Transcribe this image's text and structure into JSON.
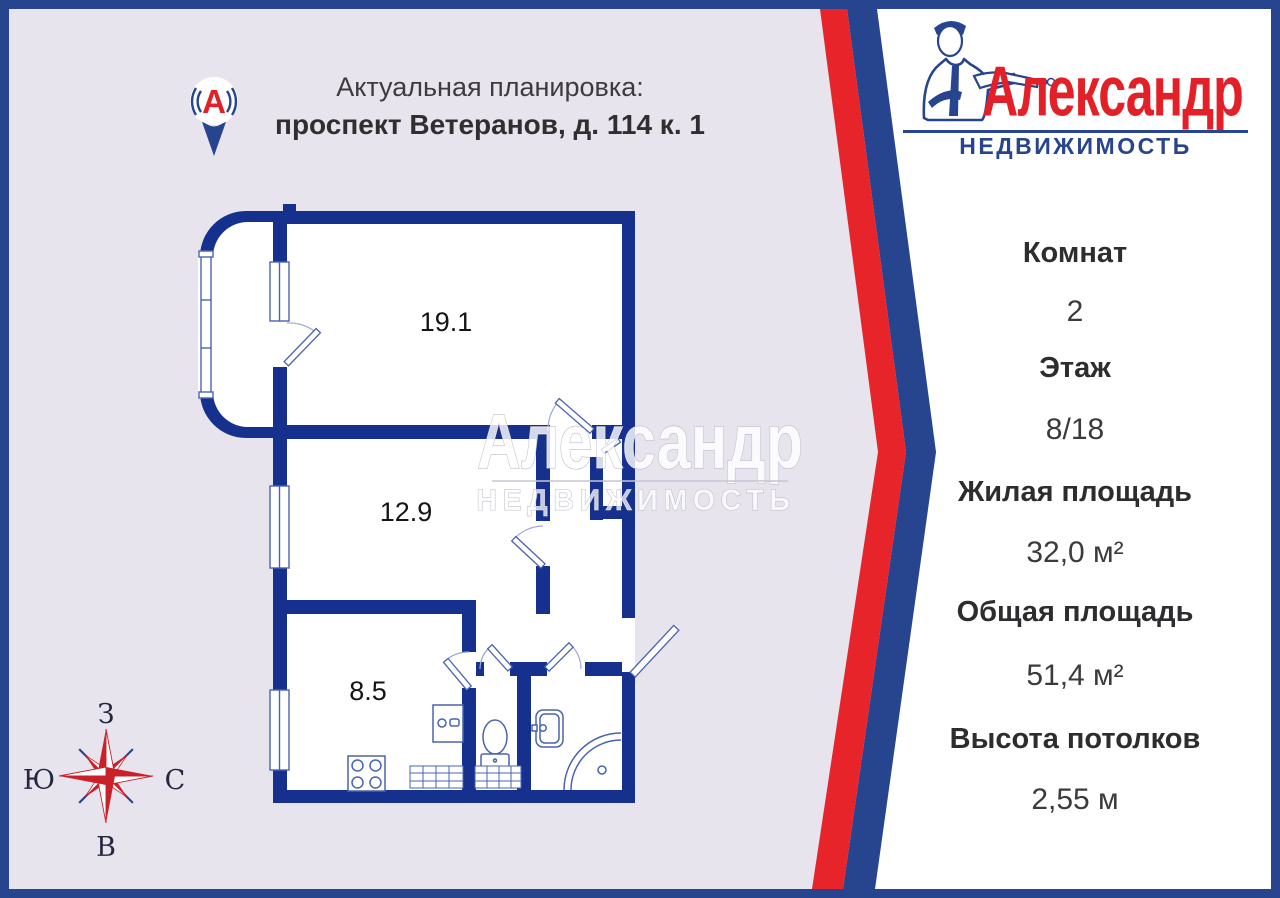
{
  "page": {
    "background": "#e8e4ee",
    "border_color": "#27458e",
    "accent_red": "#e8242b",
    "accent_navy": "#27458e",
    "wall_color": "#15318d"
  },
  "header": {
    "pin_letter": "А",
    "title": "Актуальная планировка:",
    "address": "проспект Ветеранов, д. 114 к. 1"
  },
  "logo": {
    "name": "Александр",
    "subtitle": "НЕДВИЖИМОСТЬ",
    "name_color": "#e32027",
    "subtitle_color": "#27458e"
  },
  "watermark": {
    "line1": "Александр",
    "line2": "НЕДВИЖИМОСТЬ"
  },
  "details": {
    "rows": [
      {
        "label": "Комнат",
        "value": "2"
      },
      {
        "label": "Этаж",
        "value": "8/18"
      },
      {
        "label": "Жилая площадь",
        "value": "32,0 м²"
      },
      {
        "label": "Общая площадь",
        "value": "51,4 м²"
      },
      {
        "label": "Высота потолков",
        "value": "2,55 м"
      }
    ]
  },
  "floor_plan": {
    "rooms": [
      {
        "name": "living-room",
        "area": "19.1"
      },
      {
        "name": "bedroom",
        "area": "12.9"
      },
      {
        "name": "kitchen",
        "area": "8.5"
      }
    ]
  },
  "compass": {
    "top": "З",
    "left": "Ю",
    "right": "С",
    "bottom": "В",
    "star_color": "#c9202a"
  }
}
